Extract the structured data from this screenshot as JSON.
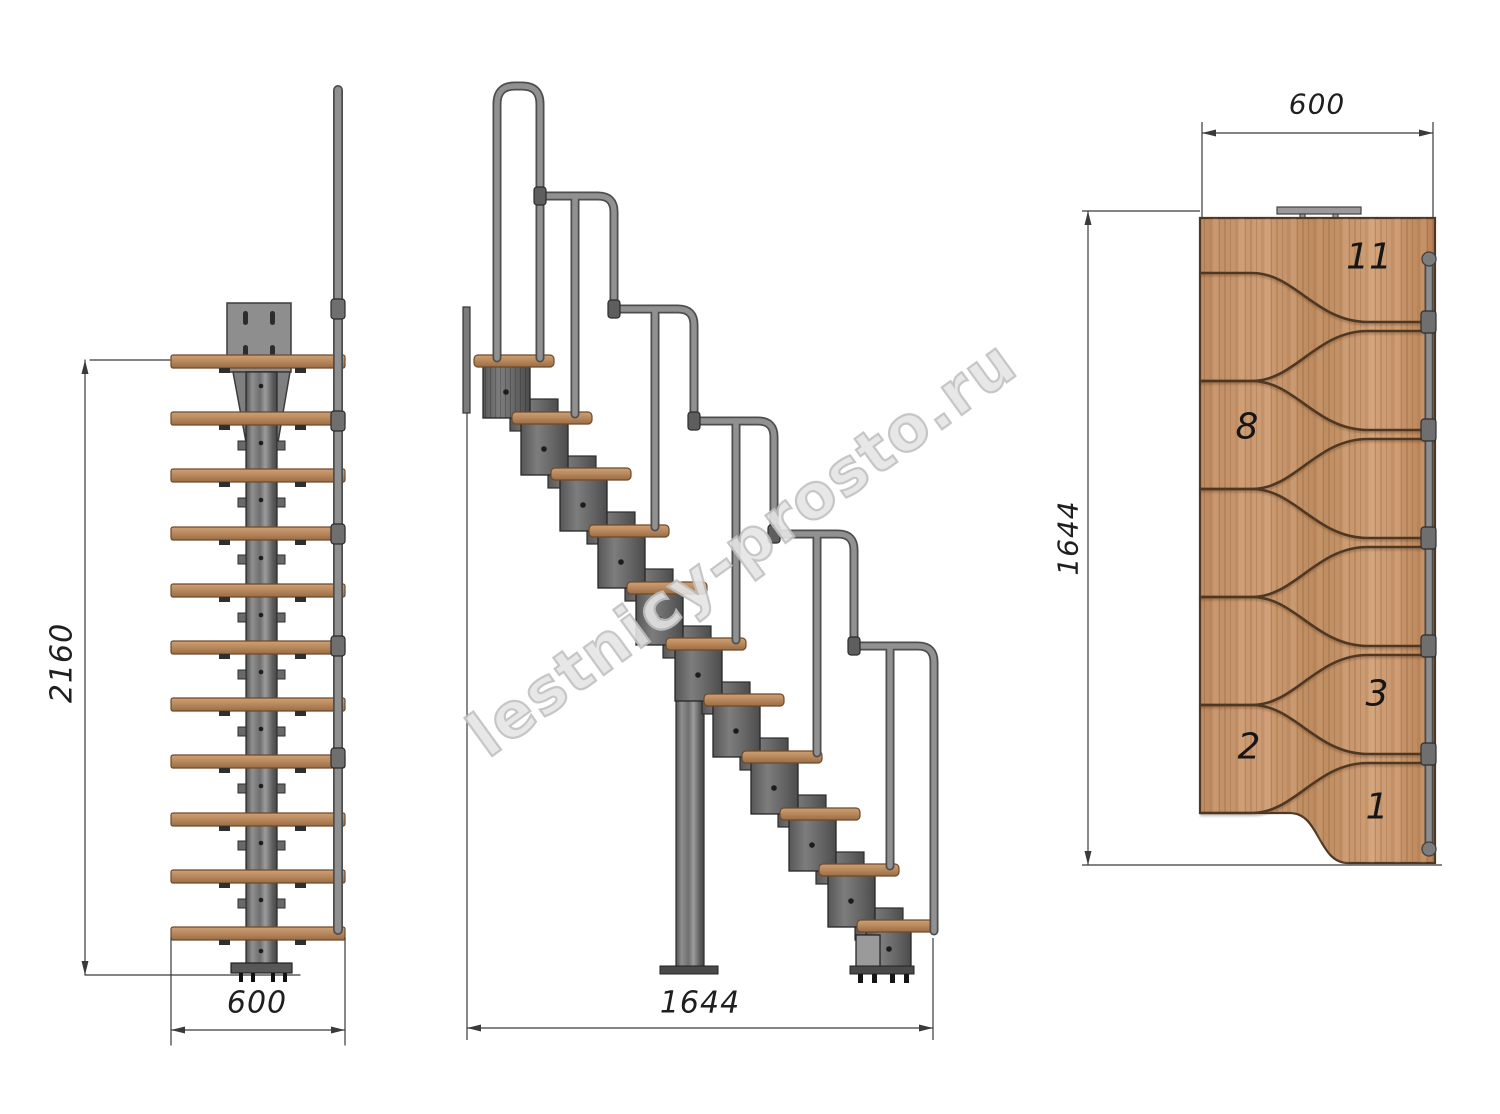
{
  "watermark": {
    "text": "lestnicy-prosto.ru"
  },
  "dimensions": {
    "front_height": "2160",
    "front_width": "600",
    "side_length": "1644",
    "plan_width": "600",
    "plan_length": "1644"
  },
  "plan_step_numbers": [
    {
      "label": "11"
    },
    {
      "label": "8"
    },
    {
      "label": "3"
    },
    {
      "label": "2"
    },
    {
      "label": "1"
    }
  ],
  "colors": {
    "tread_wood": "#b9895f",
    "plan_wood": "#c69068",
    "module_metal": "#6d6d6d",
    "handrail_tube": "#8d8d8d",
    "dimension_line": "#3a3a3a",
    "step_number_text": "#161616",
    "watermark_outline": "#c0c0c0"
  }
}
